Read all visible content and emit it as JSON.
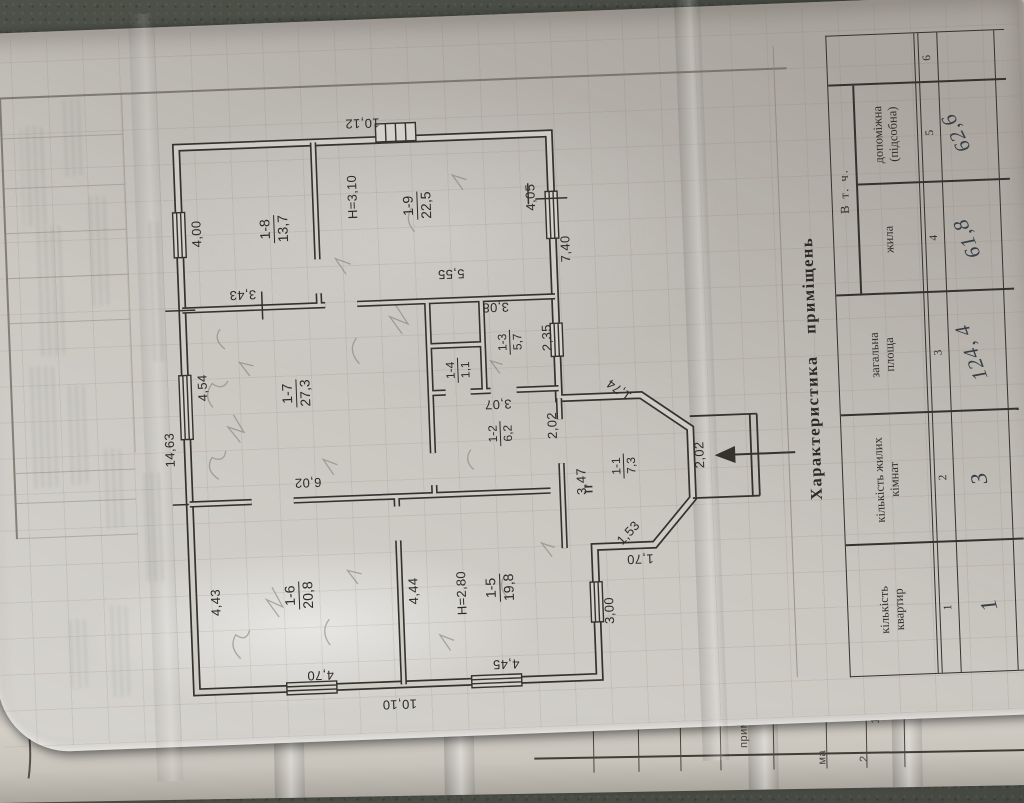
{
  "plan": {
    "overall": {
      "top_width": "14,63",
      "right_height": "10,12",
      "left_height": "10,10",
      "bottom_right": "7,40",
      "bottom_left": "3,00"
    },
    "rooms": {
      "r11": {
        "num": "1-1",
        "area": "7,3"
      },
      "r12": {
        "num": "1-2",
        "area": "6,2"
      },
      "r13": {
        "num": "1-3",
        "area": "5,7"
      },
      "r14": {
        "num": "1-4",
        "area": "1,1"
      },
      "r15": {
        "num": "1-5",
        "area": "19,8",
        "height": "H=2,80"
      },
      "r16": {
        "num": "1-6",
        "area": "20,8"
      },
      "r17": {
        "num": "1-7",
        "area": "27,3"
      },
      "r18": {
        "num": "1-8",
        "area": "13,7"
      },
      "r19": {
        "num": "1-9",
        "area": "22,5",
        "height": "H=3,10"
      }
    },
    "dims": {
      "r18_w": "4,00",
      "r18_h": "3,43",
      "r19_w": "4,05",
      "r19_h": "5,55",
      "r17_w": "4,54",
      "r17_h": "6,02",
      "r16_w": "4,43",
      "r16_h": "4,70",
      "r15_w": "4,44",
      "r15_h": "4,45",
      "r13_h": "3,08",
      "r13_w": "2,35",
      "r12_h": "3,07",
      "r12_w": "2,02",
      "hall_w": "3,47",
      "porch_door": "2,02",
      "diag_left": "1,53",
      "diag_right": "1,74",
      "vest_side": "1,70"
    }
  },
  "table": {
    "title": "Характеристика приміщень",
    "group_header": "В т. ч.",
    "headers": {
      "flats": "кількість\nквартир",
      "living_rooms": "кількість жилих\nкімнат",
      "total_area": "загальна\nплоща",
      "living": "жила",
      "auxiliary": "допоміжна\n(підсобна)"
    },
    "col_numbers": [
      "1",
      "2",
      "3",
      "4",
      "5",
      "6"
    ],
    "values": {
      "flats": "1",
      "living_rooms": "3",
      "total_area": "124, 4",
      "living": "61,8",
      "auxiliary": "62,6"
    }
  },
  "under_sheet": {
    "labels": {
      "note": "примітка",
      "surplus": "лишки",
      "ma": "ма",
      "n13": "13",
      "n2": "2"
    }
  }
}
